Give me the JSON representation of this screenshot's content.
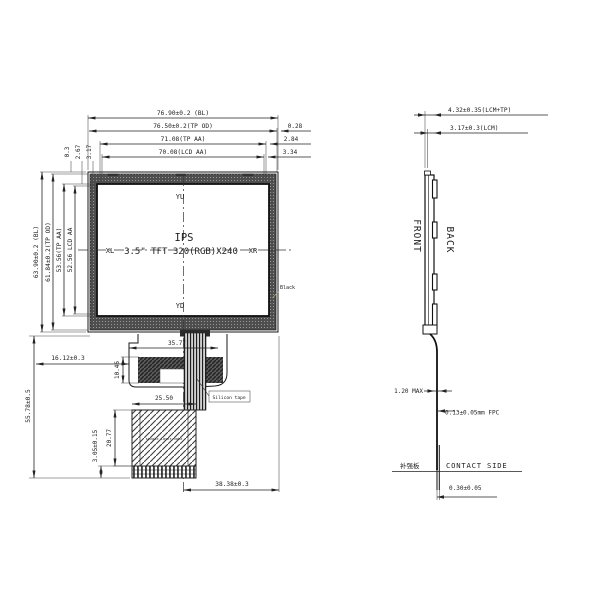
{
  "drawing": {
    "front": {
      "dim_bl_width": "76.90±0.2 (BL)",
      "dim_tp_od_width": "76.50±0.2(TP OD)",
      "dim_tp_aa_width": "71.08(TP AA)",
      "dim_lcd_aa_width": "70.08(LCD AA)",
      "gap_right_tp_od": "0.28",
      "gap_right_tp_aa": "2.84",
      "gap_right_lcd_aa": "3.34",
      "dim_bl_height": "63.90±0.2 (BL)",
      "dim_tp_od_height": "61.84±0.2(TP OD)",
      "dim_tp_aa_height": "53.56(TP AA)",
      "dim_lcd_aa_height": "52.56 LCD AA",
      "gap_top_bl": "0.3",
      "gap_top_tp_aa": "2.67",
      "gap_top_lcd_aa": "3.17",
      "axis_top": "YU",
      "axis_left": "XL",
      "axis_right": "XR",
      "axis_bottom": "YD",
      "screen_line1": "IPS",
      "screen_line2": "3.5\" TFT 320(RGB)X240",
      "bezel_color_note": "Black"
    },
    "fpc": {
      "dim_total_height": "55.78±0.5",
      "dim_left_offset": "16.12±0.3",
      "dim_tape_height": "10.46",
      "dim_top_width": "35.77",
      "tape_label": "Silicon tape",
      "dim_stiffener_width": "25.50",
      "dim_stiffener_height": "20.77",
      "dim_finger_height": "3.05±0.15",
      "dim_center_to_edge": "38.38±0.3",
      "stiffener_note": "single layer note"
    },
    "side": {
      "dim_total_thickness": "4.32±0.35(LCM+TP)",
      "dim_lcm_thickness": "3.17±0.3(LCM)",
      "label_front": "FRONT",
      "label_back": "BACK",
      "dim_bend": "1.20 MAX",
      "dim_fpc_thickness": "0.13±0.05mm FPC",
      "label_stiffener": "补强板",
      "label_contact_side": "CONTACT SIDE",
      "dim_contact_thickness": "0.30±0.05"
    }
  }
}
